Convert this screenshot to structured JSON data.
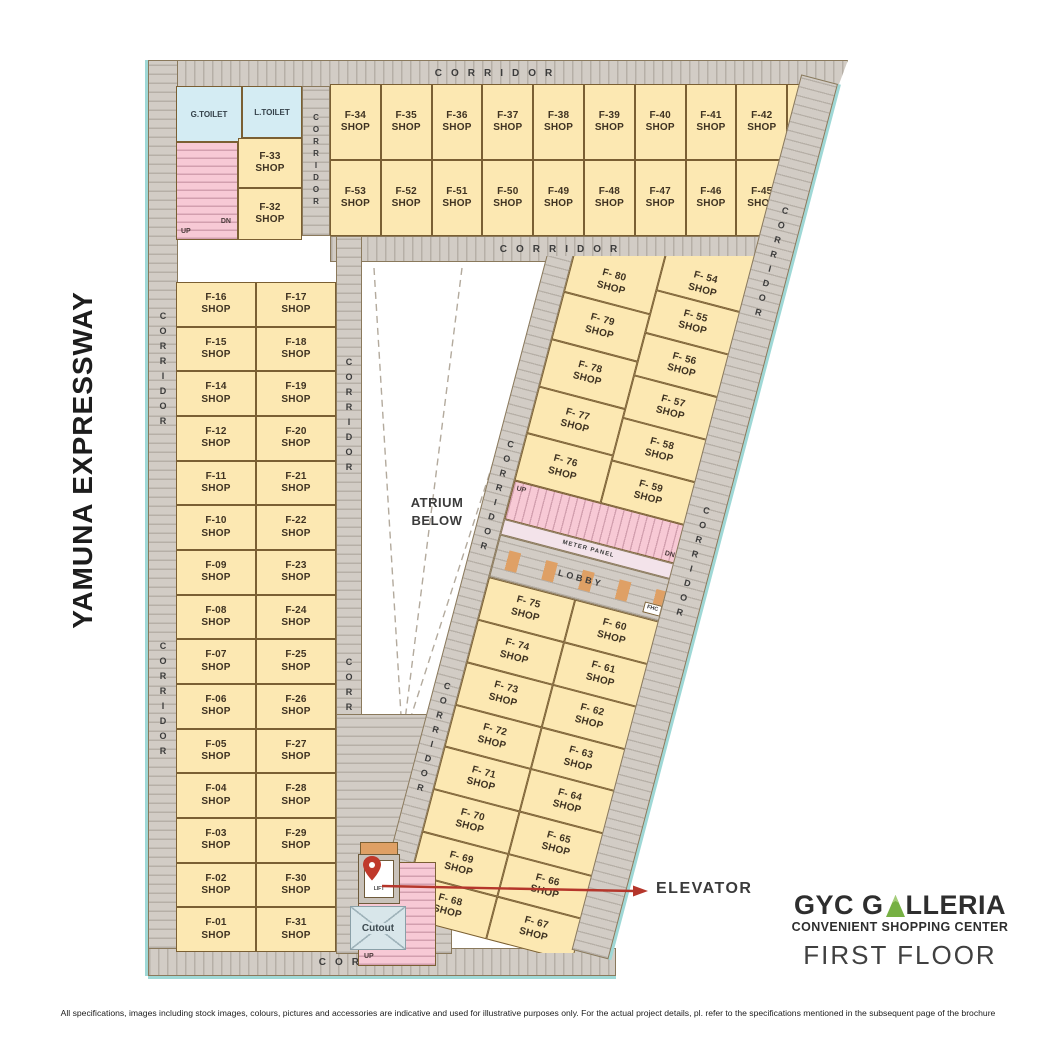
{
  "page": {
    "side_label": "YAMUNA EXPRESSWAY",
    "disclaimer": "All specifications, images including stock images, colours, pictures and accessories are indicative and used for illustrative purposes only. For the actual project details, pl. refer to the specifications mentioned in the subsequent page of the brochure"
  },
  "logo": {
    "brand_prefix": "GYC G",
    "brand_suffix": "LLERIA",
    "subtitle": "CONVENIENT SHOPPING CENTER",
    "floor": "FIRST FLOOR"
  },
  "labels": {
    "corridor": "CORRIDOR",
    "atrium_line1": "ATRIUM",
    "atrium_line2": "BELOW",
    "elevator": "ELEVATOR",
    "meter_panel": "METER PANEL",
    "lobby": "LOBBY",
    "fhc": "FHC",
    "g_toilet": "G.TOILET",
    "l_toilet": "L.TOILET",
    "up": "UP",
    "dn": "DN",
    "lift": "LIFT",
    "cutout": "Cutout",
    "shop": "SHOP"
  },
  "plan": {
    "utility_shops": [
      "F-33",
      "F-32"
    ],
    "top_row1": [
      "F-34",
      "F-35",
      "F-36",
      "F-37",
      "F-38",
      "F-39",
      "F-40",
      "F-41",
      "F-42",
      "F-43"
    ],
    "top_row2": [
      "F-53",
      "F-52",
      "F-51",
      "F-50",
      "F-49",
      "F-48",
      "F-47",
      "F-46",
      "F-45",
      "F-44"
    ],
    "left_rows": [
      [
        "F-16",
        "F-17"
      ],
      [
        "F-15",
        "F-18"
      ],
      [
        "F-14",
        "F-19"
      ],
      [
        "F-12",
        "F-20"
      ],
      [
        "F-11",
        "F-21"
      ],
      [
        "F-10",
        "F-22"
      ],
      [
        "F-09",
        "F-23"
      ],
      [
        "F-08",
        "F-24"
      ],
      [
        "F-07",
        "F-25"
      ],
      [
        "F-06",
        "F-26"
      ],
      [
        "F-05",
        "F-27"
      ],
      [
        "F-04",
        "F-28"
      ],
      [
        "F-03",
        "F-29"
      ],
      [
        "F-02",
        "F-30"
      ],
      [
        "F-01",
        "F-31"
      ]
    ],
    "wing_upper_left": [
      "F- 80",
      "F- 79",
      "F- 78",
      "F- 77",
      "F- 76"
    ],
    "wing_upper_right": [
      "F- 54",
      "F- 55",
      "F- 56",
      "F- 57",
      "F- 58",
      "F- 59"
    ],
    "wing_lower_left": [
      "F- 75",
      "F- 74",
      "F- 73",
      "F- 72",
      "F- 71",
      "F- 70",
      "F- 69",
      "F- 68"
    ],
    "wing_lower_right": [
      "F- 60",
      "F- 61",
      "F- 62",
      "F- 63",
      "F- 64",
      "F- 65",
      "F- 66",
      "F- 67"
    ]
  },
  "colors": {
    "shop_fill": "#fce8b2",
    "wall_brown": "#7a5f33",
    "corridor_gray": "#d2ccc5",
    "stairs_pink": "#f7c9d5",
    "toilet_blue": "#d4ecf3",
    "lobby_orange": "#dfa065",
    "outline_cyan": "#9fd8d6",
    "arrow_red": "#b5362b",
    "brand_green": "#76b043"
  }
}
